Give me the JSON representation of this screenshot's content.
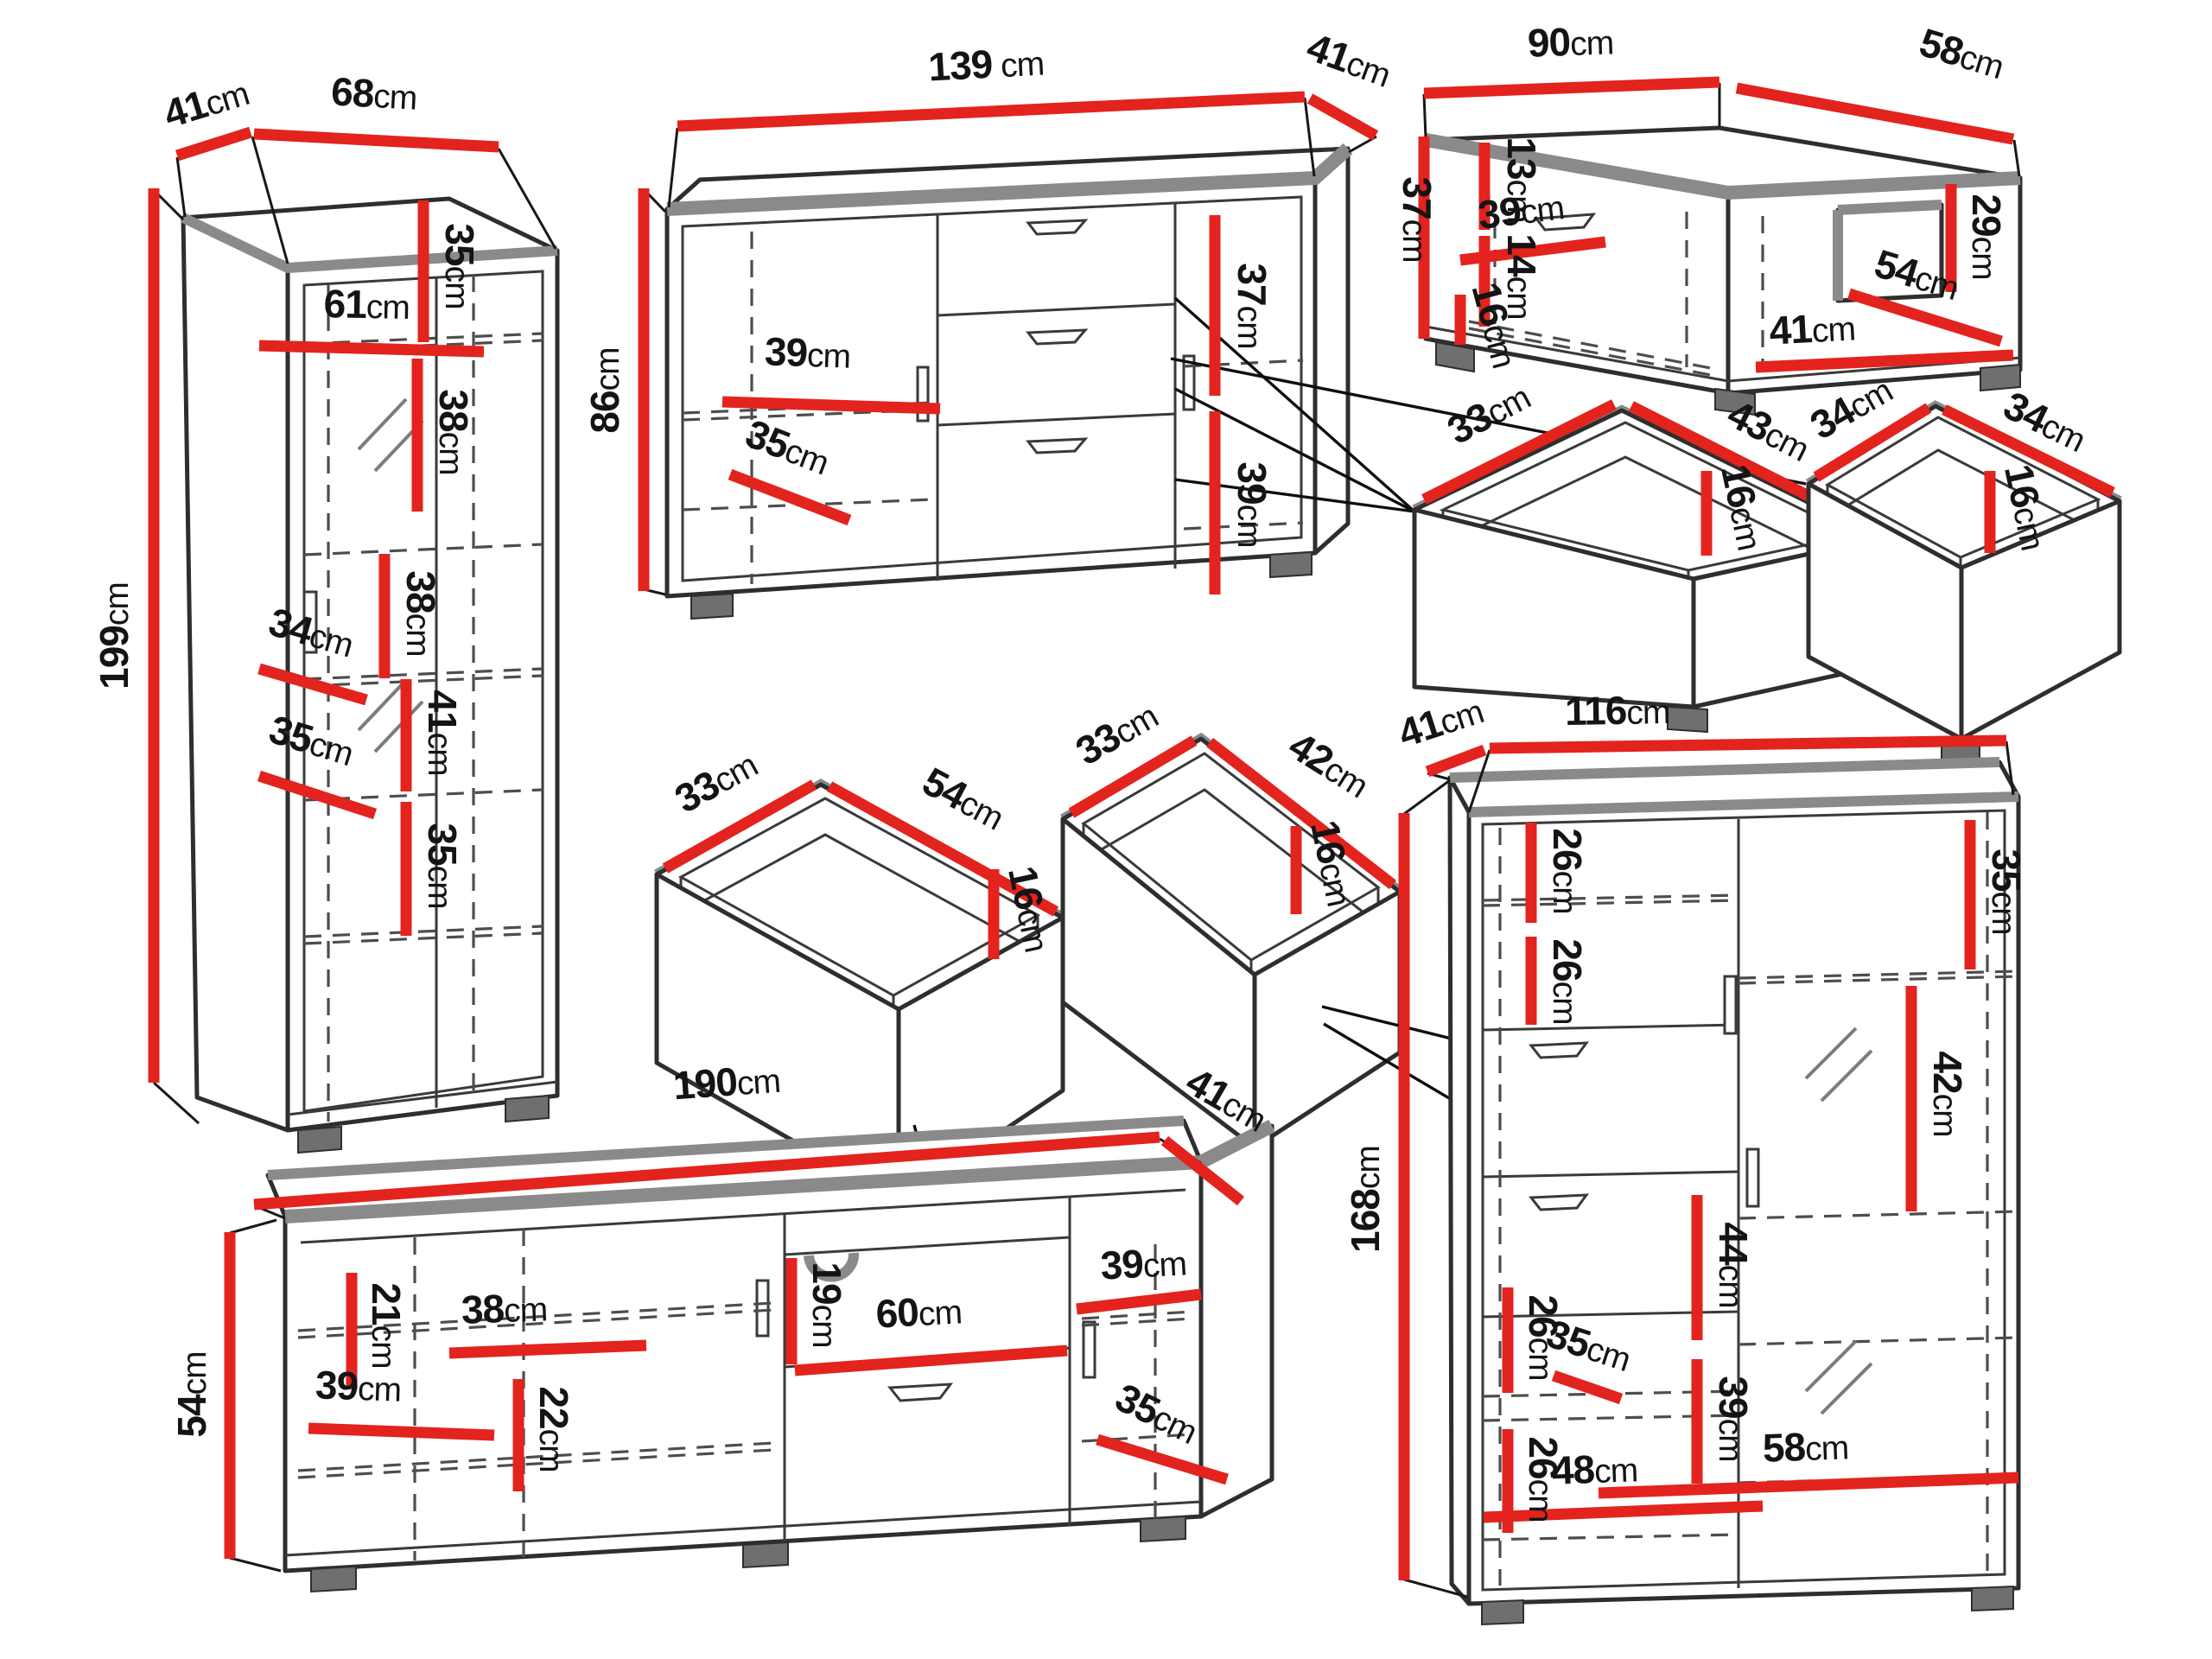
{
  "palette": {
    "dimension_red": "#e3231d",
    "outline_ink": "#2e2e2e",
    "edge_gray": "#8a8a8a"
  },
  "pieces": {
    "vitrine": {
      "title": "tall display cabinet",
      "dims": [
        {
          "name": "depth",
          "v": "41",
          "u": "cm"
        },
        {
          "name": "width",
          "v": "68",
          "u": "cm"
        },
        {
          "name": "height",
          "v": "199",
          "u": "cm"
        },
        {
          "name": "top-shelf",
          "v": "35",
          "u": "cm"
        },
        {
          "name": "inner-width",
          "v": "61",
          "u": "cm"
        },
        {
          "name": "shelf-b",
          "v": "38",
          "u": "cm"
        },
        {
          "name": "shelf-c",
          "v": "38",
          "u": "cm"
        },
        {
          "name": "inner-depth-upper",
          "v": "34",
          "u": "cm"
        },
        {
          "name": "shelf-d",
          "v": "41",
          "u": "cm"
        },
        {
          "name": "inner-depth-lower",
          "v": "35",
          "u": "cm"
        },
        {
          "name": "shelf-e",
          "v": "35",
          "u": "cm"
        }
      ]
    },
    "sideboard": {
      "title": "sideboard with drawers",
      "dims": [
        {
          "name": "width",
          "v": "139",
          "u": " cm"
        },
        {
          "name": "depth",
          "v": "41",
          "u": "cm"
        },
        {
          "name": "height",
          "v": "86",
          "u": "cm"
        },
        {
          "name": "shelf-width",
          "v": "39",
          "u": "cm"
        },
        {
          "name": "inner-depth",
          "v": "35",
          "u": "cm"
        },
        {
          "name": "right-upper",
          "v": "37",
          "u": "cm"
        },
        {
          "name": "right-lower",
          "v": "39",
          "u": "cm"
        }
      ]
    },
    "coffee_table": {
      "title": "coffee table",
      "dims": [
        {
          "name": "width",
          "v": "90",
          "u": "cm"
        },
        {
          "name": "depth",
          "v": "58",
          "u": "cm"
        },
        {
          "name": "height",
          "v": "37",
          "u": "cm"
        },
        {
          "name": "left-upper",
          "v": "13",
          "u": "cm"
        },
        {
          "name": "left-lower",
          "v": "14",
          "u": "cm"
        },
        {
          "name": "shelf-width",
          "v": "39",
          "u": "cm"
        },
        {
          "name": "inner-height",
          "v": "16",
          "u": "cm"
        },
        {
          "name": "niche-height",
          "v": "29",
          "u": "cm"
        },
        {
          "name": "inner-diagonal",
          "v": "54",
          "u": "cm"
        },
        {
          "name": "inner-width",
          "v": "41",
          "u": "cm"
        }
      ]
    },
    "drawer_a": {
      "title": "drawer 33x43",
      "dims": [
        {
          "name": "side",
          "v": "33",
          "u": "cm"
        },
        {
          "name": "front",
          "v": "43",
          "u": "cm"
        },
        {
          "name": "height",
          "v": "16",
          "u": "cm"
        }
      ]
    },
    "drawer_b": {
      "title": "drawer 34x34",
      "dims": [
        {
          "name": "side",
          "v": "34",
          "u": "cm"
        },
        {
          "name": "front",
          "v": "34",
          "u": "cm"
        },
        {
          "name": "height",
          "v": "16",
          "u": "cm"
        }
      ]
    },
    "drawer_c": {
      "title": "drawer 33x54",
      "dims": [
        {
          "name": "side",
          "v": "33",
          "u": "cm"
        },
        {
          "name": "front",
          "v": "54",
          "u": "cm"
        },
        {
          "name": "height",
          "v": "16",
          "u": "cm"
        }
      ]
    },
    "drawer_d": {
      "title": "drawer 33x42",
      "dims": [
        {
          "name": "side",
          "v": "33",
          "u": "cm"
        },
        {
          "name": "front",
          "v": "42",
          "u": "cm"
        },
        {
          "name": "height",
          "v": "16",
          "u": "cm"
        }
      ]
    },
    "tv_stand": {
      "title": "TV stand",
      "dims": [
        {
          "name": "width",
          "v": "190",
          "u": "cm"
        },
        {
          "name": "depth",
          "v": "41",
          "u": "cm"
        },
        {
          "name": "height",
          "v": "54",
          "u": "cm"
        },
        {
          "name": "left-height",
          "v": "21",
          "u": "cm"
        },
        {
          "name": "left-shelf",
          "v": "38",
          "u": "cm"
        },
        {
          "name": "bottom-shelf",
          "v": "39",
          "u": "cm"
        },
        {
          "name": "mid-height",
          "v": "22",
          "u": "cm"
        },
        {
          "name": "niche-height",
          "v": "19",
          "u": "cm"
        },
        {
          "name": "niche-width",
          "v": "60",
          "u": "cm"
        },
        {
          "name": "right-shelf",
          "v": "39",
          "u": "cm"
        },
        {
          "name": "inner-depth",
          "v": "35",
          "u": "cm"
        }
      ]
    },
    "highboard": {
      "title": "highboard cabinet",
      "dims": [
        {
          "name": "depth",
          "v": "41",
          "u": "cm"
        },
        {
          "name": "width",
          "v": "116",
          "u": "cm"
        },
        {
          "name": "height",
          "v": "168",
          "u": "cm"
        },
        {
          "name": "left-1",
          "v": "26",
          "u": "cm"
        },
        {
          "name": "left-2",
          "v": "26",
          "u": "cm"
        },
        {
          "name": "left-3",
          "v": "26",
          "u": "cm"
        },
        {
          "name": "left-4",
          "v": "26",
          "u": "cm"
        },
        {
          "name": "right-top",
          "v": "35",
          "u": "cm"
        },
        {
          "name": "right-2",
          "v": "42",
          "u": "cm"
        },
        {
          "name": "right-3",
          "v": "44",
          "u": "cm"
        },
        {
          "name": "right-4",
          "v": "39",
          "u": "cm"
        },
        {
          "name": "inner-depth",
          "v": "35",
          "u": "cm"
        },
        {
          "name": "bottom-left",
          "v": "48",
          "u": "cm"
        },
        {
          "name": "bottom-right",
          "v": "58",
          "u": "cm"
        }
      ]
    }
  }
}
